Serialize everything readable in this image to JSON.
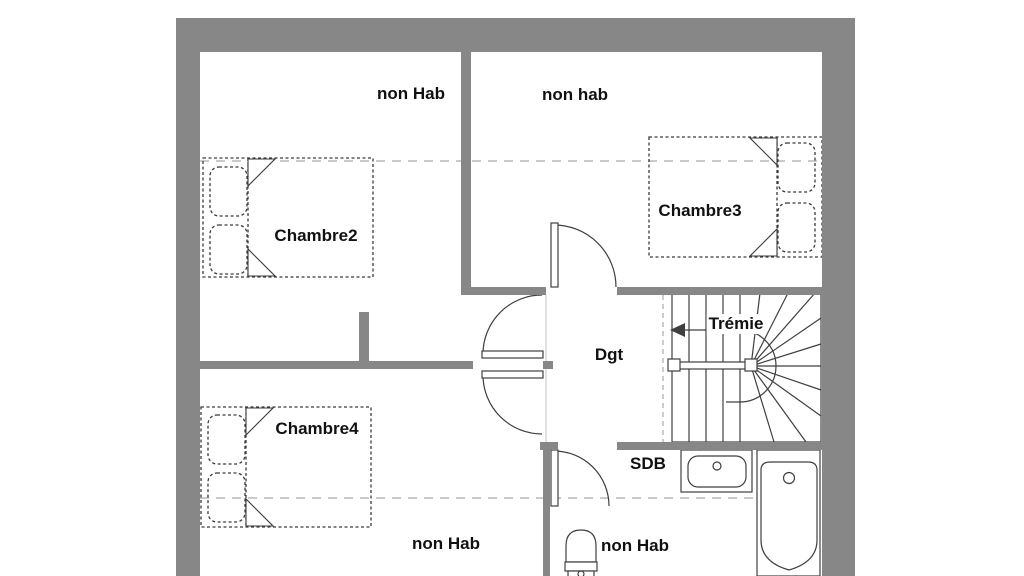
{
  "plan": {
    "room_labels": {
      "chambre2": "Chambre2",
      "chambre3": "Chambre3",
      "chambre4": "Chambre4",
      "dgt": "Dgt",
      "sdb": "SDB"
    },
    "area_labels": {
      "top_left": "non Hab",
      "top_right": "non hab",
      "bottom_left": "non Hab",
      "bottom_right": "non Hab"
    },
    "stair_label": "Trémie",
    "colors": {
      "wall": "#878787",
      "line": "#3f3f3f",
      "dashed_line": "#b8b8b8",
      "text": "#111111",
      "background": "#ffffff"
    }
  }
}
